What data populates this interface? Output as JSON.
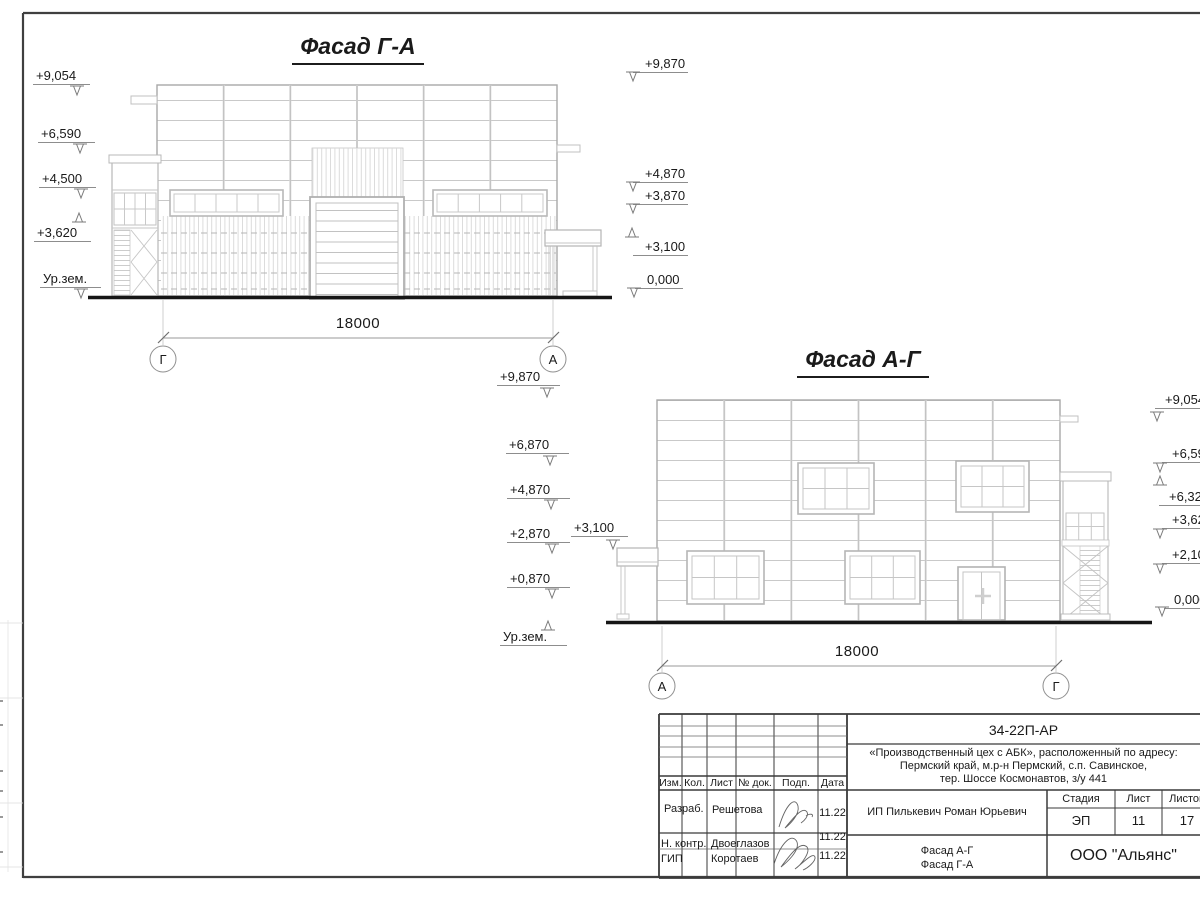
{
  "facade_ga": {
    "title": "Фасад Г-А",
    "dim": "18000",
    "axis_left": "Г",
    "axis_right": "А",
    "marks_left": [
      "+9,054",
      "+6,590",
      "+4,500",
      "+3,620",
      "Ур.зем."
    ],
    "marks_right": [
      "+9,870",
      "+4,870",
      "+3,870",
      "+3,100",
      "0,000"
    ]
  },
  "facade_ag": {
    "title": "Фасад А-Г",
    "dim": "18000",
    "axis_left": "А",
    "axis_right": "Г",
    "marks_left": [
      "+9,870",
      "+6,870",
      "+4,870",
      "+2,870",
      "+0,870",
      "Ур.зем."
    ],
    "mark_canopy": "+3,100",
    "marks_right": [
      "+9,054",
      "+6,590",
      "+6,320",
      "+3,620",
      "+2,100",
      "0,000"
    ]
  },
  "title_block": {
    "doc_code": "34-22П-АР",
    "project_name_lines": [
      "«Производственный цех с АБК», расположенный по адресу:",
      "Пермский край, м.р-н Пермский, с.п. Савинское,",
      "тер. Шоссе Космонавтов, з/у 441"
    ],
    "client": "ИП Пилькевич Роман Юрьевич",
    "columns": [
      "Изм.",
      "Кол.",
      "Лист",
      "№ док.",
      "Подп.",
      "Дата"
    ],
    "stage_label": "Стадия",
    "sheet_label": "Лист",
    "sheets_label": "Листов",
    "stage": "ЭП",
    "sheet_no": "11",
    "sheets_total": "17",
    "drawing_titles": [
      "Фасад А-Г",
      "Фасад Г-А"
    ],
    "company": "ООО \"Альянс\"",
    "rows": [
      {
        "role": "Разраб.",
        "name": "Решетова",
        "date": "11.22"
      },
      {
        "role": "Н. контр.",
        "name": "Двоеглазов",
        "date": "11.22"
      },
      {
        "role": "ГИП",
        "name": "Коротаев",
        "date": "11.22"
      }
    ]
  }
}
